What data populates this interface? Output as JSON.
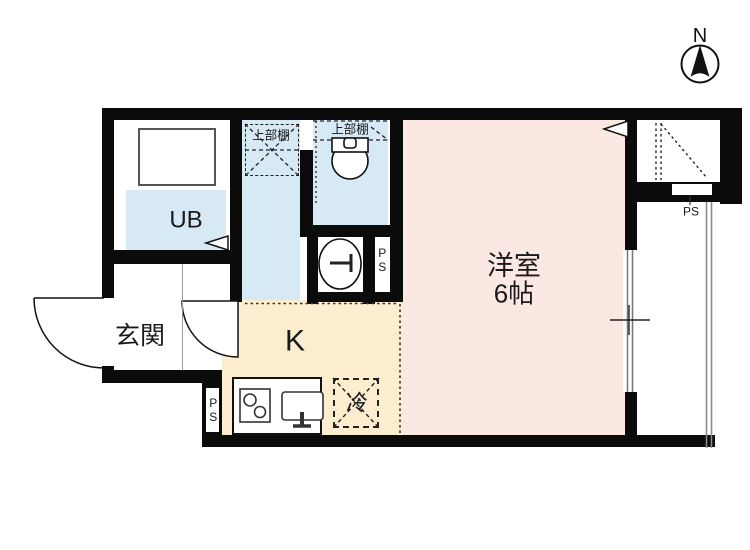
{
  "title": "1K apartment floor plan",
  "compass": {
    "label": "N"
  },
  "rooms": {
    "unit_bath": {
      "label": "UB"
    },
    "entrance": {
      "label": "玄関"
    },
    "kitchen": {
      "label": "K"
    },
    "western_room": {
      "label": "洋室",
      "size": "6帖"
    }
  },
  "fixtures": {
    "upper_shelf_left": "上部棚",
    "upper_shelf_toilet": "上部棚",
    "refrigerator": "冷",
    "pipe_space_wash": "PS",
    "pipe_space_kitchen": "PS",
    "pipe_space_balcony": "PS"
  },
  "colors": {
    "wall": "#0b0b0b",
    "wet_area": "#d8e9f6",
    "main_room": "#fce8e2",
    "kitchen": "#fcedcf"
  }
}
